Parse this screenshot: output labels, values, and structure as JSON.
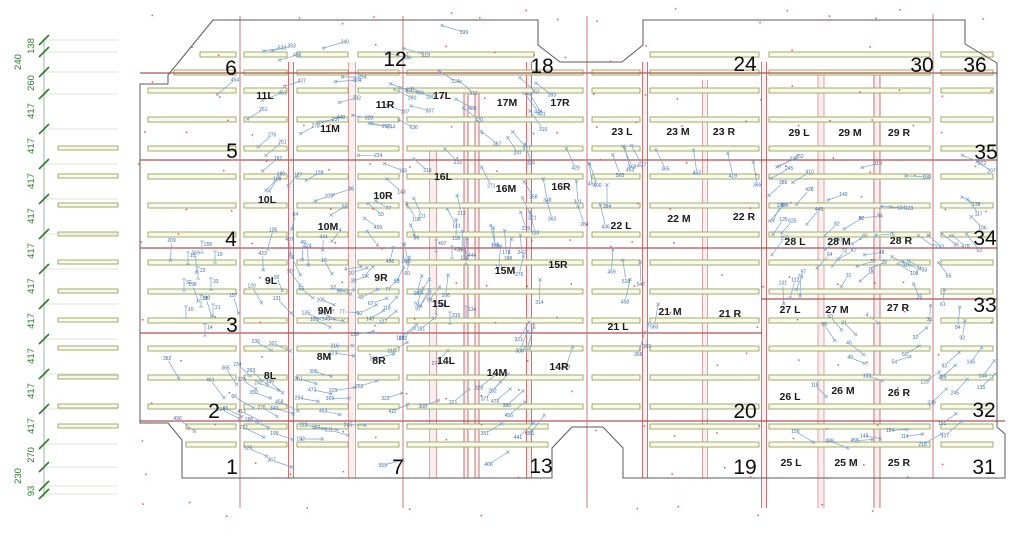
{
  "canvas": {
    "w": 1024,
    "h": 541
  },
  "colors": {
    "bg": "#ffffff",
    "outline": "#5a5a5a",
    "dim_green": "#2e7d2e",
    "ext_gray": "#d8d8cc",
    "bar_stroke": "#9aa455",
    "bar_fill": "#f8f9ee",
    "red_line": "#b05555",
    "pink_single": "#cc7777",
    "band_edge_dark": "#bb6868",
    "band_edge_light": "#d89a9a",
    "band_fill": "rgba(228,150,150,0.16)",
    "dot_red": "#e25555",
    "mark_line": "#7aa0cc",
    "mark_text": "#3a6db0"
  },
  "outline_path": [
    [
      213,
      20
    ],
    [
      538,
      20
    ],
    [
      538,
      45
    ],
    [
      560,
      62
    ],
    [
      622,
      62
    ],
    [
      643,
      45
    ],
    [
      643,
      20
    ],
    [
      965,
      20
    ],
    [
      965,
      44
    ],
    [
      997,
      63
    ],
    [
      997,
      427
    ],
    [
      1005,
      434
    ],
    [
      1005,
      478
    ],
    [
      623,
      478
    ],
    [
      623,
      448
    ],
    [
      603,
      427
    ],
    [
      572,
      427
    ],
    [
      552,
      448
    ],
    [
      552,
      478
    ],
    [
      182,
      478
    ],
    [
      182,
      440
    ],
    [
      168,
      423
    ],
    [
      140,
      423
    ],
    [
      140,
      84
    ],
    [
      168,
      84
    ],
    [
      168,
      75
    ],
    [
      213,
      20
    ]
  ],
  "dim_chain": {
    "x": 44,
    "y_top": 38,
    "y_bottom": 497,
    "ext_x2": 118,
    "ticks": [
      40,
      52,
      72,
      94,
      129,
      164,
      199,
      234,
      269,
      304,
      339,
      374,
      409,
      444,
      467,
      486,
      494
    ],
    "labels": [
      {
        "t": "138",
        "y": 46,
        "dx": 0
      },
      {
        "t": "240",
        "y": 62,
        "dx": -13
      },
      {
        "t": "260",
        "y": 83,
        "dx": 0
      },
      {
        "t": "417",
        "y": 111,
        "dx": 0
      },
      {
        "t": "417",
        "y": 146,
        "dx": 0
      },
      {
        "t": "417",
        "y": 181,
        "dx": 0
      },
      {
        "t": "417",
        "y": 216,
        "dx": 0
      },
      {
        "t": "417",
        "y": 251,
        "dx": 0
      },
      {
        "t": "417",
        "y": 286,
        "dx": 0
      },
      {
        "t": "417",
        "y": 321,
        "dx": 0
      },
      {
        "t": "417",
        "y": 356,
        "dx": 0
      },
      {
        "t": "417",
        "y": 391,
        "dx": 0
      },
      {
        "t": "417",
        "y": 426,
        "dx": 0
      },
      {
        "t": "270",
        "y": 455,
        "dx": 0
      },
      {
        "t": "230",
        "y": 476,
        "dx": -13
      },
      {
        "t": "93",
        "y": 491,
        "dx": 0
      }
    ]
  },
  "grid_numbers": [
    {
      "t": "6",
      "x": 231,
      "y": 67
    },
    {
      "t": "12",
      "x": 395,
      "y": 58
    },
    {
      "t": "18",
      "x": 542,
      "y": 65
    },
    {
      "t": "24",
      "x": 745,
      "y": 63
    },
    {
      "t": "30",
      "x": 922,
      "y": 64
    },
    {
      "t": "36",
      "x": 975,
      "y": 64
    },
    {
      "t": "5",
      "x": 232,
      "y": 150
    },
    {
      "t": "4",
      "x": 231,
      "y": 238
    },
    {
      "t": "3",
      "x": 232,
      "y": 324
    },
    {
      "t": "2",
      "x": 214,
      "y": 410
    },
    {
      "t": "1",
      "x": 232,
      "y": 466
    },
    {
      "t": "7",
      "x": 398,
      "y": 466
    },
    {
      "t": "13",
      "x": 541,
      "y": 465
    },
    {
      "t": "19",
      "x": 745,
      "y": 466
    },
    {
      "t": "31",
      "x": 984,
      "y": 466
    },
    {
      "t": "35",
      "x": 986,
      "y": 151
    },
    {
      "t": "34",
      "x": 985,
      "y": 237
    },
    {
      "t": "33",
      "x": 985,
      "y": 304
    },
    {
      "t": "32",
      "x": 984,
      "y": 409
    },
    {
      "t": "20",
      "x": 745,
      "y": 410
    }
  ],
  "zone_labels": [
    {
      "t": "11L",
      "x": 265,
      "y": 95
    },
    {
      "t": "11R",
      "x": 385,
      "y": 104
    },
    {
      "t": "11M",
      "x": 330,
      "y": 128
    },
    {
      "t": "17L",
      "x": 442,
      "y": 95
    },
    {
      "t": "17M",
      "x": 507,
      "y": 102
    },
    {
      "t": "17R",
      "x": 560,
      "y": 102
    },
    {
      "t": "23 L",
      "x": 622,
      "y": 131
    },
    {
      "t": "23 M",
      "x": 678,
      "y": 131
    },
    {
      "t": "23 R",
      "x": 724,
      "y": 131
    },
    {
      "t": "29 L",
      "x": 799,
      "y": 132
    },
    {
      "t": "29 M",
      "x": 850,
      "y": 132
    },
    {
      "t": "29 R",
      "x": 899,
      "y": 132
    },
    {
      "t": "10L",
      "x": 267,
      "y": 199
    },
    {
      "t": "10R",
      "x": 383,
      "y": 195
    },
    {
      "t": "16L",
      "x": 443,
      "y": 176
    },
    {
      "t": "16M",
      "x": 506,
      "y": 188
    },
    {
      "t": "16R",
      "x": 561,
      "y": 186
    },
    {
      "t": "22 L",
      "x": 621,
      "y": 225
    },
    {
      "t": "22 M",
      "x": 679,
      "y": 218
    },
    {
      "t": "22 R",
      "x": 744,
      "y": 216
    },
    {
      "t": "28 L",
      "x": 795,
      "y": 241
    },
    {
      "t": "28 M",
      "x": 839,
      "y": 241
    },
    {
      "t": "28 R",
      "x": 901,
      "y": 240
    },
    {
      "t": "10M",
      "x": 328,
      "y": 226
    },
    {
      "t": "9L",
      "x": 271,
      "y": 280
    },
    {
      "t": "9R",
      "x": 381,
      "y": 277
    },
    {
      "t": "15M",
      "x": 505,
      "y": 270
    },
    {
      "t": "15R",
      "x": 558,
      "y": 264
    },
    {
      "t": "21 L",
      "x": 618,
      "y": 326
    },
    {
      "t": "21 M",
      "x": 670,
      "y": 311
    },
    {
      "t": "21 R",
      "x": 730,
      "y": 313
    },
    {
      "t": "27 L",
      "x": 790,
      "y": 309
    },
    {
      "t": "27 M",
      "x": 837,
      "y": 309
    },
    {
      "t": "27 R",
      "x": 898,
      "y": 307
    },
    {
      "t": "9M",
      "x": 325,
      "y": 310
    },
    {
      "t": "15L",
      "x": 441,
      "y": 303
    },
    {
      "t": "8M",
      "x": 324,
      "y": 356
    },
    {
      "t": "8R",
      "x": 379,
      "y": 360
    },
    {
      "t": "8L",
      "x": 270,
      "y": 375
    },
    {
      "t": "14L",
      "x": 446,
      "y": 360
    },
    {
      "t": "14M",
      "x": 497,
      "y": 372
    },
    {
      "t": "14R",
      "x": 559,
      "y": 366
    },
    {
      "t": "26 L",
      "x": 790,
      "y": 396
    },
    {
      "t": "26 M",
      "x": 843,
      "y": 390
    },
    {
      "t": "26 R",
      "x": 899,
      "y": 392
    },
    {
      "t": "25 L",
      "x": 791,
      "y": 462
    },
    {
      "t": "25 M",
      "x": 846,
      "y": 462
    },
    {
      "t": "25 R",
      "x": 899,
      "y": 462
    }
  ],
  "red_hlines": [
    {
      "y": 73,
      "x1": 140,
      "x2": 997
    },
    {
      "y": 160,
      "x1": 140,
      "x2": 997
    },
    {
      "y": 248,
      "x1": 140,
      "x2": 997
    },
    {
      "y": 333,
      "x1": 140,
      "x2": 762
    },
    {
      "y": 299,
      "x1": 762,
      "x2": 997
    },
    {
      "y": 421,
      "x1": 140,
      "x2": 1005
    }
  ],
  "red_vlines": {
    "singles": [
      {
        "x": 240,
        "y1": 16,
        "y2": 508
      },
      {
        "x": 403,
        "y1": 16,
        "y2": 508
      },
      {
        "x": 587,
        "y1": 16,
        "y2": 508
      },
      {
        "x": 933,
        "y1": 14,
        "y2": 478
      }
    ],
    "bands": [
      {
        "x": 291,
        "w": 5,
        "y1": 62,
        "y2": 478,
        "dark": true
      },
      {
        "x": 352,
        "w": 7,
        "y1": 62,
        "y2": 478,
        "dark": false
      },
      {
        "x": 433,
        "w": 7,
        "y1": 150,
        "y2": 478,
        "dark": false
      },
      {
        "x": 466,
        "w": 4,
        "y1": 90,
        "y2": 478,
        "dark": true
      },
      {
        "x": 477,
        "w": 4,
        "y1": 90,
        "y2": 478,
        "dark": true
      },
      {
        "x": 529,
        "w": 5,
        "y1": 62,
        "y2": 478,
        "dark": true
      },
      {
        "x": 645,
        "w": 5,
        "y1": 62,
        "y2": 478,
        "dark": true
      },
      {
        "x": 705,
        "w": 5,
        "y1": 80,
        "y2": 478,
        "dark": false
      },
      {
        "x": 764,
        "w": 5,
        "y1": 62,
        "y2": 508,
        "dark": true
      },
      {
        "x": 821,
        "w": 6,
        "y1": 75,
        "y2": 508,
        "dark": false
      },
      {
        "x": 877,
        "w": 6,
        "y1": 75,
        "y2": 508,
        "dark": true
      }
    ]
  },
  "green_bars": {
    "rows": [
      52,
      70,
      88,
      117,
      146,
      174,
      203,
      232,
      260,
      289,
      318,
      346,
      375,
      404,
      424,
      442
    ],
    "bar_h": 5,
    "segments": [
      [
        148,
        236
      ],
      [
        244,
        287
      ],
      [
        297,
        348
      ],
      [
        358,
        399
      ],
      [
        407,
        583
      ],
      [
        592,
        640
      ],
      [
        650,
        759
      ],
      [
        769,
        930
      ],
      [
        941,
        993
      ]
    ],
    "outer_col": {
      "x1": 58,
      "x2": 118,
      "rows": [
        146,
        174,
        203,
        232,
        260,
        289,
        318,
        346,
        375,
        404,
        424
      ],
      "bar_h": 4
    }
  },
  "red_dots": {
    "x1": 146,
    "x2": 1012,
    "y1": 14,
    "y2": 512,
    "step": 38,
    "jitter": 9,
    "keep": 0.62,
    "seed": 99
  },
  "marks": {
    "featured": [
      [
        351,
        77,
        254
      ],
      [
        420,
        92,
        280
      ],
      [
        402,
        93,
        280
      ],
      [
        419,
        108,
        307
      ],
      [
        395,
        108,
        307
      ],
      [
        345,
        81,
        604
      ],
      [
        380,
        125,
        644
      ],
      [
        405,
        123,
        636
      ],
      [
        463,
        103,
        486
      ],
      [
        470,
        113,
        420
      ],
      [
        287,
        58,
        456
      ],
      [
        395,
        55,
        466
      ],
      [
        225,
        88,
        454
      ],
      [
        271,
        97,
        451
      ],
      [
        330,
        120,
        448
      ],
      [
        323,
        245,
        444
      ],
      [
        308,
        257,
        424
      ],
      [
        290,
        248,
        407
      ],
      [
        263,
        263,
        423
      ],
      [
        370,
        222,
        459
      ],
      [
        392,
        253,
        456
      ],
      [
        218,
        390,
        461
      ],
      [
        250,
        385,
        224
      ],
      [
        270,
        387,
        242
      ],
      [
        323,
        392,
        473
      ],
      [
        310,
        400,
        254
      ],
      [
        333,
        413,
        453
      ],
      [
        358,
        425,
        246
      ],
      [
        315,
        427,
        222
      ],
      [
        340,
        433,
        211
      ],
      [
        285,
        437,
        199
      ],
      [
        313,
        439,
        192
      ],
      [
        255,
        433,
        212
      ],
      [
        260,
        424,
        186
      ],
      [
        245,
        403,
        66
      ],
      [
        235,
        413,
        65
      ],
      [
        290,
        407,
        458
      ],
      [
        958,
        240,
        478
      ],
      [
        972,
        241,
        53
      ],
      [
        898,
        260,
        119
      ],
      [
        905,
        268,
        108
      ],
      [
        950,
        370,
        285
      ],
      [
        962,
        385,
        245
      ],
      [
        940,
        395,
        239
      ],
      [
        627,
        155,
        368
      ],
      [
        660,
        158,
        365
      ],
      [
        695,
        160,
        452
      ],
      [
        730,
        163,
        419
      ],
      [
        755,
        172,
        365
      ],
      [
        788,
        162,
        452
      ],
      [
        800,
        178,
        410
      ],
      [
        775,
        190,
        389
      ],
      [
        802,
        198,
        428
      ],
      [
        776,
        214,
        408
      ],
      [
        786,
        228,
        625
      ],
      [
        812,
        218,
        445
      ],
      [
        607,
        194,
        384
      ],
      [
        577,
        190,
        321
      ],
      [
        545,
        188,
        348
      ],
      [
        865,
        440,
        458
      ],
      [
        840,
        445,
        488
      ],
      [
        900,
        430,
        154
      ],
      [
        915,
        435,
        114
      ]
    ],
    "vertical": [
      [
        188,
        258,
        15
      ],
      [
        215,
        257,
        19
      ],
      [
        198,
        273,
        22
      ],
      [
        184,
        285,
        32
      ],
      [
        211,
        284,
        33
      ],
      [
        201,
        301,
        38
      ],
      [
        186,
        312,
        10
      ],
      [
        213,
        310,
        21
      ],
      [
        205,
        330,
        14
      ],
      [
        202,
        247,
        295
      ],
      [
        436,
        246,
        407
      ],
      [
        452,
        252,
        424
      ],
      [
        466,
        258,
        444
      ],
      [
        450,
        318,
        316
      ],
      [
        436,
        308,
        306
      ],
      [
        466,
        312,
        134
      ]
    ],
    "field": {
      "seed": 11,
      "centers": [
        {
          "cx": 352,
          "cy": 250,
          "n": 175,
          "rmin": 23,
          "rmax": 320,
          "ey": 0.74,
          "vk": 1.6,
          "left": 152,
          "right": 758,
          "top": 28,
          "bottom": 472
        },
        {
          "cx": 884,
          "cy": 300,
          "n": 65,
          "rmin": 18,
          "rmax": 175,
          "ey": 1.0,
          "vk": 1.3,
          "left": 762,
          "right": 999,
          "top": 132,
          "bottom": 470
        }
      ]
    }
  }
}
